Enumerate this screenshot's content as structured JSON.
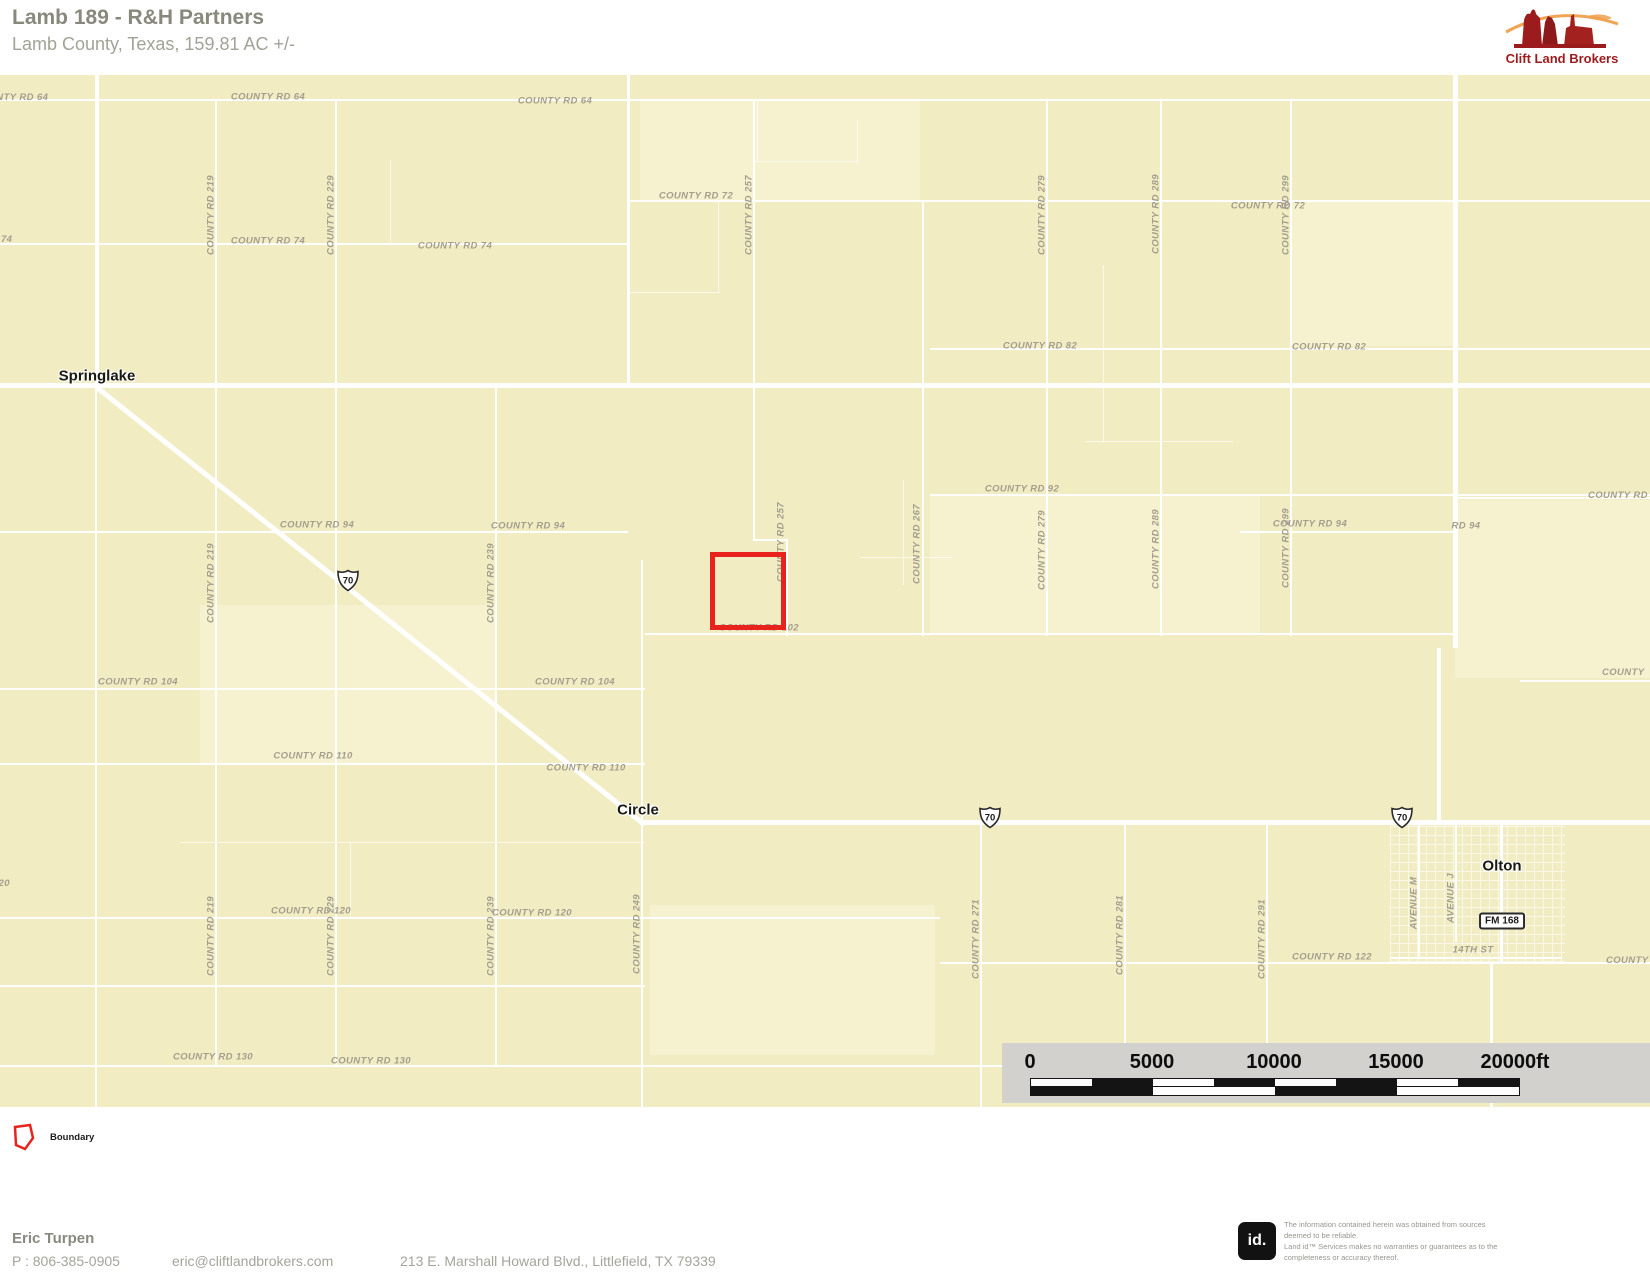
{
  "header": {
    "title": "Lamb 189 - R&H Partners",
    "subtitle": "Lamb County, Texas, 159.81 AC +/-",
    "brand": "Clift Land Brokers"
  },
  "colors": {
    "map_bg": "#f2ecc3",
    "road": "#ffffff",
    "road_label": "#a39e8e",
    "boundary": "#e8231d",
    "brand_red": "#9c1c1d",
    "brand_orange": "#f09a3e",
    "scalebar_bg": "#d2d1cd"
  },
  "map": {
    "towns": [
      {
        "t": "Springlake",
        "x": 97,
        "y": 376
      },
      {
        "t": "Circle",
        "x": 638,
        "y": 810
      },
      {
        "t": "Olton",
        "x": 1502,
        "y": 866
      }
    ],
    "boundary": {
      "x": 710,
      "y": 552,
      "w": 76,
      "h": 78
    },
    "shields_us70": [
      {
        "t": "70",
        "x": 348,
        "y": 583
      },
      {
        "t": "70",
        "x": 990,
        "y": 820
      },
      {
        "t": "70",
        "x": 1402,
        "y": 820
      }
    ],
    "shield_fm": {
      "t": "FM 168",
      "x": 1502,
      "y": 921
    },
    "road_labels": [
      {
        "t": "COUNTY RD 64",
        "x": -26,
        "y": 92,
        "a": "l"
      },
      {
        "t": "COUNTY RD 64",
        "x": 268,
        "y": 97
      },
      {
        "t": "COUNTY RD 64",
        "x": 555,
        "y": 101
      },
      {
        "t": "COUNTY RD 72",
        "x": 696,
        "y": 196
      },
      {
        "t": "COUNTY RD 72",
        "x": 1268,
        "y": 206
      },
      {
        "t": "COUNTY RD 74",
        "x": 268,
        "y": 241
      },
      {
        "t": "COUNTY RD 74",
        "x": 455,
        "y": 246
      },
      {
        "t": "COUNTY RD 74",
        "x": -62,
        "y": 234,
        "a": "l"
      },
      {
        "t": "COUNTY RD 82",
        "x": 1040,
        "y": 346
      },
      {
        "t": "COUNTY RD 82",
        "x": 1329,
        "y": 347
      },
      {
        "t": "COUNTY RD 92",
        "x": 1022,
        "y": 489
      },
      {
        "t": "COUNTY RD 94",
        "x": 317,
        "y": 525
      },
      {
        "t": "COUNTY RD 94",
        "x": 528,
        "y": 526
      },
      {
        "t": "COUNTY RD 94",
        "x": 1310,
        "y": 524
      },
      {
        "t": "RD 94",
        "x": 1466,
        "y": 526
      },
      {
        "t": "COUNTY RD",
        "x": 1588,
        "y": 490,
        "a": "l"
      },
      {
        "t": "COUNTY RD 102",
        "x": 759,
        "y": 628
      },
      {
        "t": "COUNTY RD 104",
        "x": 138,
        "y": 682
      },
      {
        "t": "COUNTY RD 104",
        "x": 575,
        "y": 682
      },
      {
        "t": "COUNTY RD 110",
        "x": 313,
        "y": 756
      },
      {
        "t": "COUNTY RD 110",
        "x": 586,
        "y": 768
      },
      {
        "t": "COUNTY RD 120",
        "x": 311,
        "y": 911
      },
      {
        "t": "COUNTY RD 120",
        "x": 532,
        "y": 913
      },
      {
        "t": "COUNTY RD 120",
        "x": -70,
        "y": 878,
        "a": "l"
      },
      {
        "t": "COUNTY RD 122",
        "x": 1332,
        "y": 957
      },
      {
        "t": "COUNTY",
        "x": 1606,
        "y": 955,
        "a": "l"
      },
      {
        "t": "COUNTY",
        "x": 1602,
        "y": 667,
        "a": "l"
      },
      {
        "t": "COUNTY RD 130",
        "x": 213,
        "y": 1057
      },
      {
        "t": "COUNTY RD 130",
        "x": 371,
        "y": 1061
      },
      {
        "t": "14TH ST",
        "x": 1473,
        "y": 950
      },
      {
        "t": "COUNTY RD 219",
        "x": 211,
        "y": 215,
        "v": 1
      },
      {
        "t": "COUNTY RD 229",
        "x": 331,
        "y": 215,
        "v": 1
      },
      {
        "t": "COUNTY RD 257",
        "x": 749,
        "y": 215,
        "v": 1
      },
      {
        "t": "COUNTY RD 279",
        "x": 1042,
        "y": 215,
        "v": 1
      },
      {
        "t": "COUNTY RD 289",
        "x": 1156,
        "y": 214,
        "v": 1
      },
      {
        "t": "COUNTY RD 299",
        "x": 1286,
        "y": 215,
        "v": 1
      },
      {
        "t": "COUNTY RD 219",
        "x": 211,
        "y": 583,
        "v": 1
      },
      {
        "t": "COUNTY RD 239",
        "x": 491,
        "y": 583,
        "v": 1
      },
      {
        "t": "COUNTY RD 257",
        "x": 781,
        "y": 542,
        "v": 1
      },
      {
        "t": "COUNTY RD 267",
        "x": 917,
        "y": 544,
        "v": 1
      },
      {
        "t": "COUNTY RD 279",
        "x": 1042,
        "y": 550,
        "v": 1
      },
      {
        "t": "COUNTY RD 289",
        "x": 1156,
        "y": 549,
        "v": 1
      },
      {
        "t": "COUNTY RD 299",
        "x": 1286,
        "y": 548,
        "v": 1
      },
      {
        "t": "COUNTY RD 219",
        "x": 211,
        "y": 936,
        "v": 1
      },
      {
        "t": "COUNTY RD 229",
        "x": 331,
        "y": 936,
        "v": 1
      },
      {
        "t": "COUNTY RD 239",
        "x": 491,
        "y": 936,
        "v": 1
      },
      {
        "t": "COUNTY RD 249",
        "x": 637,
        "y": 934,
        "v": 1
      },
      {
        "t": "COUNTY RD 271",
        "x": 976,
        "y": 939,
        "v": 1
      },
      {
        "t": "COUNTY RD 281",
        "x": 1120,
        "y": 935,
        "v": 1
      },
      {
        "t": "COUNTY RD 291",
        "x": 1262,
        "y": 939,
        "v": 1
      },
      {
        "t": "AVENUE M",
        "x": 1414,
        "y": 903,
        "v": 1
      },
      {
        "t": "AVENUE J",
        "x": 1451,
        "y": 898,
        "v": 1
      }
    ],
    "roads_h": [
      [
        0,
        99,
        1650,
        2
      ],
      [
        628,
        200,
        1022,
        2
      ],
      [
        0,
        243,
        628,
        2
      ],
      [
        930,
        348,
        720,
        2
      ],
      [
        0,
        383,
        1650,
        5
      ],
      [
        930,
        494,
        720,
        2
      ],
      [
        0,
        531,
        628,
        2
      ],
      [
        1240,
        531,
        213,
        2
      ],
      [
        1455,
        497,
        195,
        2
      ],
      [
        645,
        633,
        810,
        2
      ],
      [
        0,
        688,
        645,
        2
      ],
      [
        0,
        763,
        645,
        2
      ],
      [
        640,
        820,
        1010,
        5
      ],
      [
        0,
        917,
        940,
        2
      ],
      [
        0,
        985,
        645,
        2
      ],
      [
        940,
        962,
        710,
        2
      ],
      [
        1520,
        680,
        130,
        2
      ],
      [
        0,
        1065,
        1005,
        2
      ],
      [
        1390,
        957,
        172,
        2
      ],
      [
        753,
        539,
        35,
        2
      ]
    ],
    "roads_v": [
      [
        95,
        75,
        310,
        4
      ],
      [
        95,
        385,
        722,
        2
      ],
      [
        215,
        99,
        966,
        2
      ],
      [
        335,
        99,
        966,
        2
      ],
      [
        495,
        383,
        682,
        2
      ],
      [
        627,
        75,
        308,
        3
      ],
      [
        641,
        560,
        547,
        2
      ],
      [
        753,
        99,
        441,
        2
      ],
      [
        786,
        540,
        96,
        2
      ],
      [
        922,
        200,
        436,
        2
      ],
      [
        980,
        822,
        285,
        2
      ],
      [
        1046,
        99,
        537,
        2
      ],
      [
        1124,
        822,
        221,
        2
      ],
      [
        1160,
        99,
        537,
        2
      ],
      [
        1266,
        822,
        221,
        2
      ],
      [
        1290,
        99,
        537,
        2
      ],
      [
        1453,
        75,
        573,
        5
      ],
      [
        1437,
        648,
        174,
        4
      ],
      [
        1500,
        822,
        142,
        3
      ],
      [
        1490,
        964,
        143,
        3
      ],
      [
        1418,
        822,
        137,
        2
      ],
      [
        1455,
        822,
        120,
        2
      ]
    ],
    "roads_faint_h": [
      [
        755,
        161,
        102
      ],
      [
        628,
        292,
        92
      ],
      [
        1085,
        441,
        148
      ],
      [
        860,
        557,
        92
      ],
      [
        180,
        842,
        465
      ]
    ],
    "roads_faint_v": [
      [
        757,
        99,
        62
      ],
      [
        857,
        120,
        45
      ],
      [
        718,
        200,
        92
      ],
      [
        1103,
        265,
        178
      ],
      [
        390,
        160,
        85
      ],
      [
        903,
        480,
        105
      ],
      [
        350,
        842,
        77
      ]
    ],
    "diagonal": {
      "x": 99,
      "y": 386,
      "len": 700,
      "angle": 38.6,
      "t": 5
    },
    "patches": [
      [
        640,
        100,
        280,
        100
      ],
      [
        930,
        495,
        330,
        138
      ],
      [
        1455,
        500,
        195,
        178
      ],
      [
        200,
        605,
        295,
        158
      ],
      [
        650,
        905,
        285,
        150
      ],
      [
        1290,
        200,
        165,
        146
      ]
    ],
    "olton_grid": [
      1390,
      826,
      175,
      138
    ]
  },
  "scale_bar": {
    "x": 1002,
    "y": 1043,
    "w": 648,
    "h": 60,
    "labels": [
      {
        "t": "0",
        "x": 1030
      },
      {
        "t": "5000",
        "x": 1152
      },
      {
        "t": "10000",
        "x": 1274
      },
      {
        "t": "15000",
        "x": 1396
      },
      {
        "t": "20000ft",
        "x": 1515
      }
    ],
    "ruler": {
      "x": 1030,
      "w": 488,
      "y": 1078,
      "row_h": 8,
      "small_seg": 61,
      "big_seg": 122,
      "dark": "#141414",
      "light": "#fdfdfd"
    }
  },
  "legend": {
    "label": "Boundary"
  },
  "footer": {
    "name": "Eric Turpen",
    "phone": "P : 806-385-0905",
    "email": "eric@cliftlandbrokers.com",
    "address": "213 E. Marshall Howard Blvd., Littlefield, TX 79339",
    "id_logo": "id.",
    "disclaimer_lines": [
      "The information contained herein was obtained from sources",
      "deemed to be reliable.",
      "Land id™ Services makes no warranties or guarantees as to the",
      "completeness or accuracy thereof."
    ]
  }
}
